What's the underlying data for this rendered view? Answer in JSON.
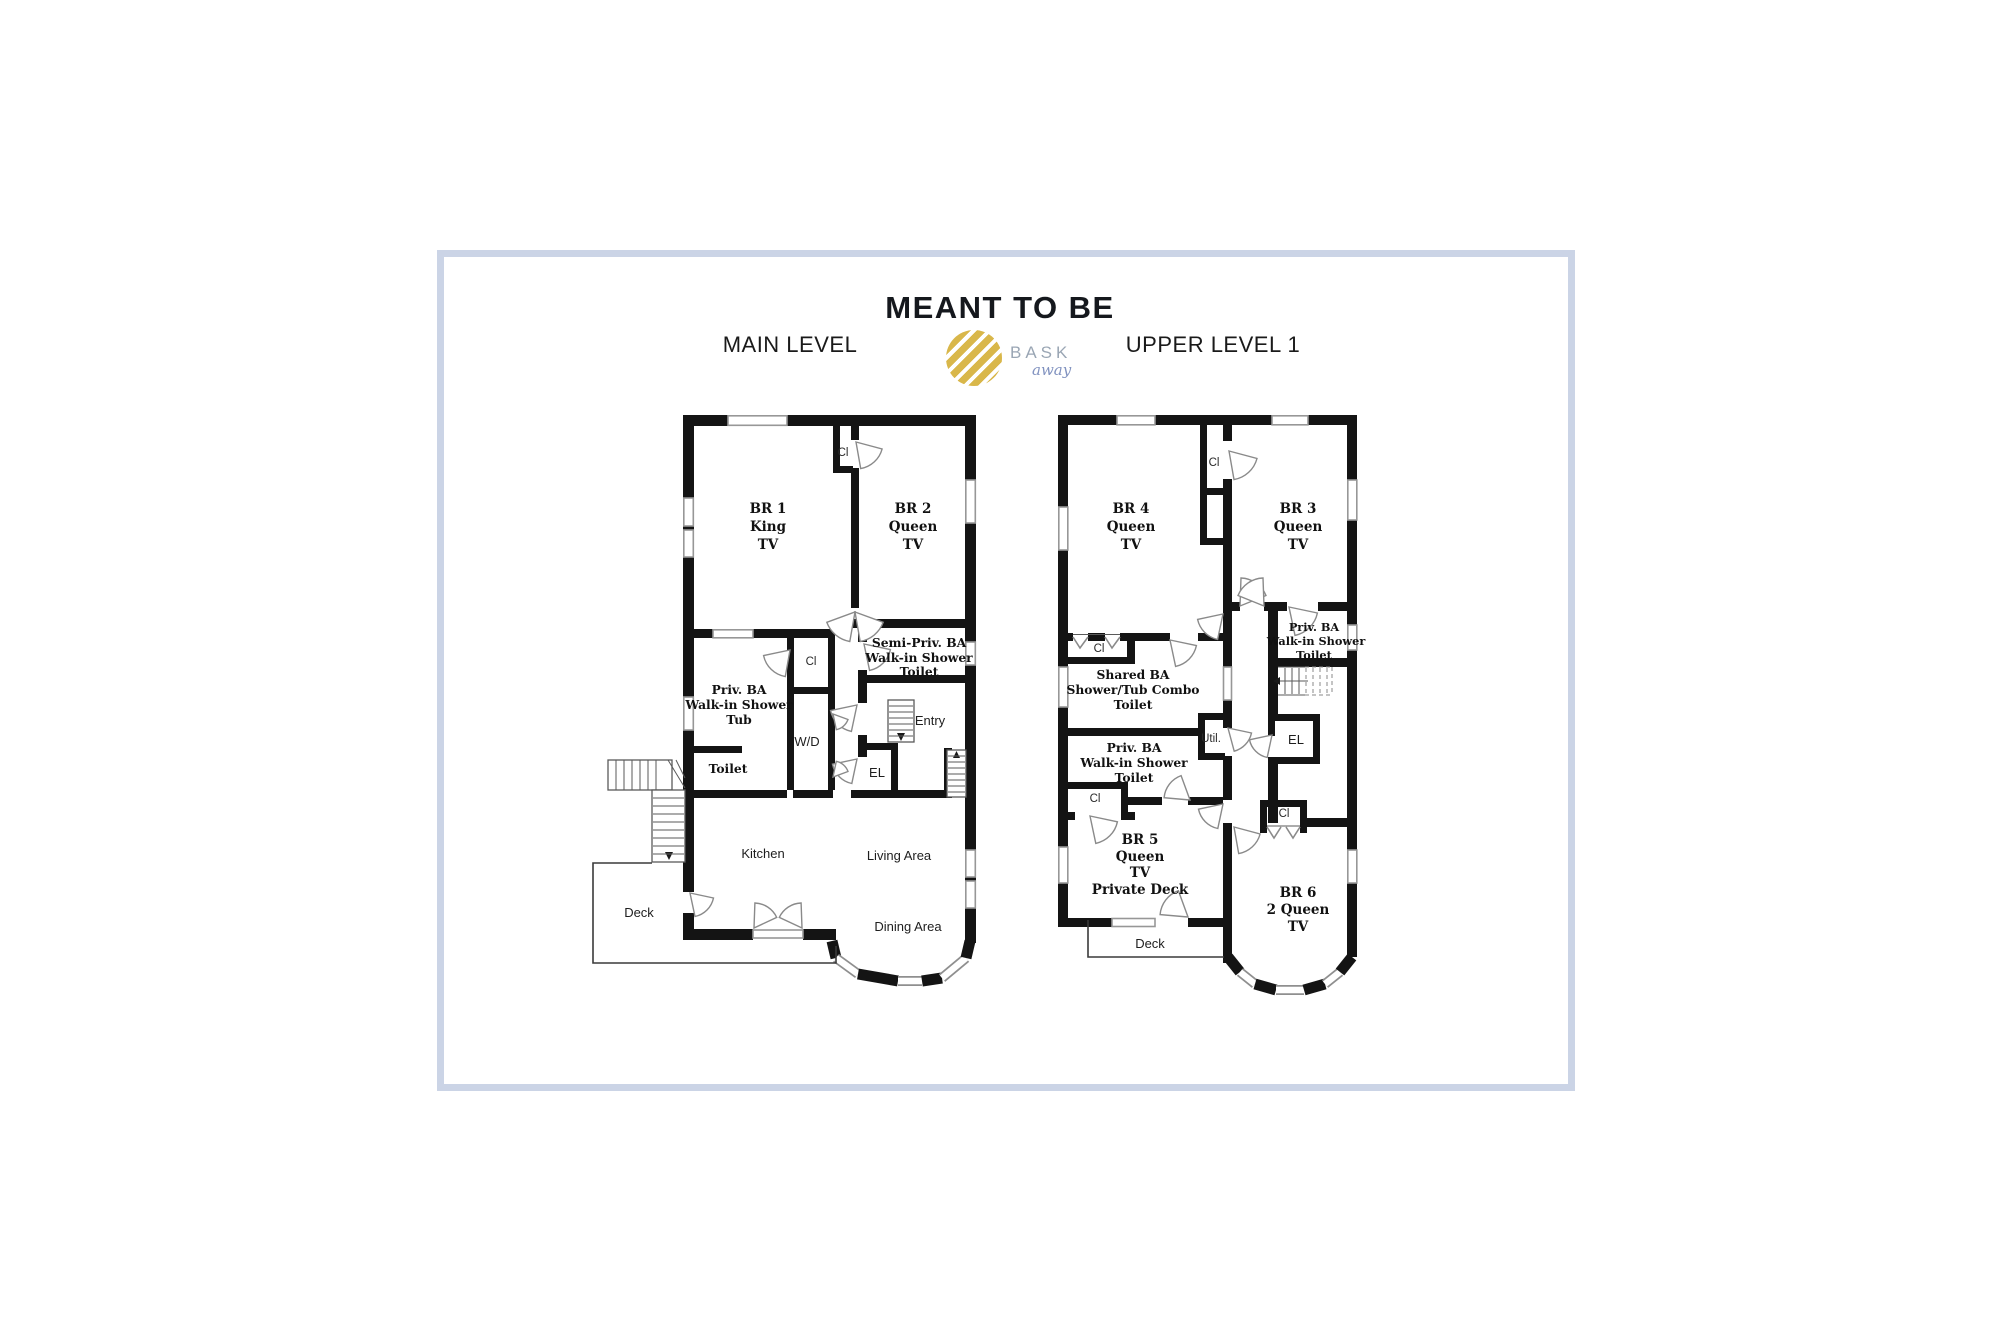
{
  "header": {
    "title": "MEANT TO BE",
    "logo": {
      "name": "BASK",
      "tagline": "away"
    }
  },
  "colors": {
    "frame_border": "#cbd4e6",
    "wall": "#141414",
    "logo_gold": "#d9b74a",
    "logo_text": "#9aa6b4",
    "logo_tagline": "#8293c0"
  },
  "main_level": {
    "label": "MAIN LEVEL",
    "rooms": {
      "br1": [
        "BR 1",
        "King",
        "TV"
      ],
      "br2": [
        "BR 2",
        "Queen",
        "TV"
      ],
      "closet_top": "Cl",
      "semi_priv_ba": [
        "Semi-Priv.  BA",
        "Walk-in Shower",
        "Toilet"
      ],
      "priv_ba": [
        "Priv. BA",
        "Walk-in Shower",
        "Tub"
      ],
      "toilet": "Toilet",
      "closet_hall": "Cl",
      "washer_dryer": "W/D",
      "entry": "Entry",
      "elevator": "EL",
      "kitchen": "Kitchen",
      "living": "Living Area",
      "dining": "Dining Area",
      "deck": "Deck"
    }
  },
  "upper_level": {
    "label": "UPPER LEVEL 1",
    "rooms": {
      "br3": [
        "BR 3",
        "Queen",
        "TV"
      ],
      "br4": [
        "BR 4",
        "Queen",
        "TV"
      ],
      "br5": [
        "BR 5",
        "Queen",
        "TV",
        "Private Deck"
      ],
      "br6": [
        "BR 6",
        "2 Queen",
        "TV"
      ],
      "closet_top": "Cl",
      "closet_br4": "Cl",
      "closet_br5": "Cl",
      "closet_br6": "Cl",
      "priv_ba_br3": [
        "Priv.  BA",
        "Walk-in Shower",
        "Toilet"
      ],
      "shared_ba": [
        "Shared  BA",
        "Shower/Tub Combo",
        "Toilet"
      ],
      "priv_ba_br5": [
        "Priv.  BA",
        "Walk-in Shower",
        "Toilet"
      ],
      "util": "Util.",
      "elevator": "EL",
      "deck": "Deck"
    }
  }
}
